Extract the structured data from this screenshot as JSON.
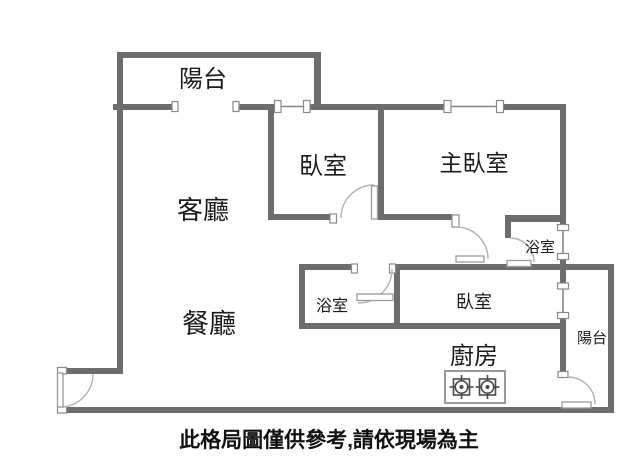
{
  "page": {
    "background": "#ffffff"
  },
  "floor_plan": {
    "labels": {
      "balcony_top": "陽台",
      "living_room": "客廳",
      "dining_room": "餐廳",
      "bedroom_small": "臥室",
      "master_bedroom": "主臥室",
      "bathroom_corridor": "浴室",
      "bathroom_lower": "浴室",
      "bedroom_lower": "臥室",
      "kitchen": "廚房",
      "balcony_right": "陽台"
    },
    "disclaimer": "此格局圖僅供參考,請依現場為主",
    "fixtures": {
      "stove": "two-burner-gas-stove"
    },
    "colors": {
      "wall": "#6d6d6d",
      "window_line": "#858585",
      "door_arc": "#b2b2b2",
      "text": "#1c1c1c"
    }
  }
}
